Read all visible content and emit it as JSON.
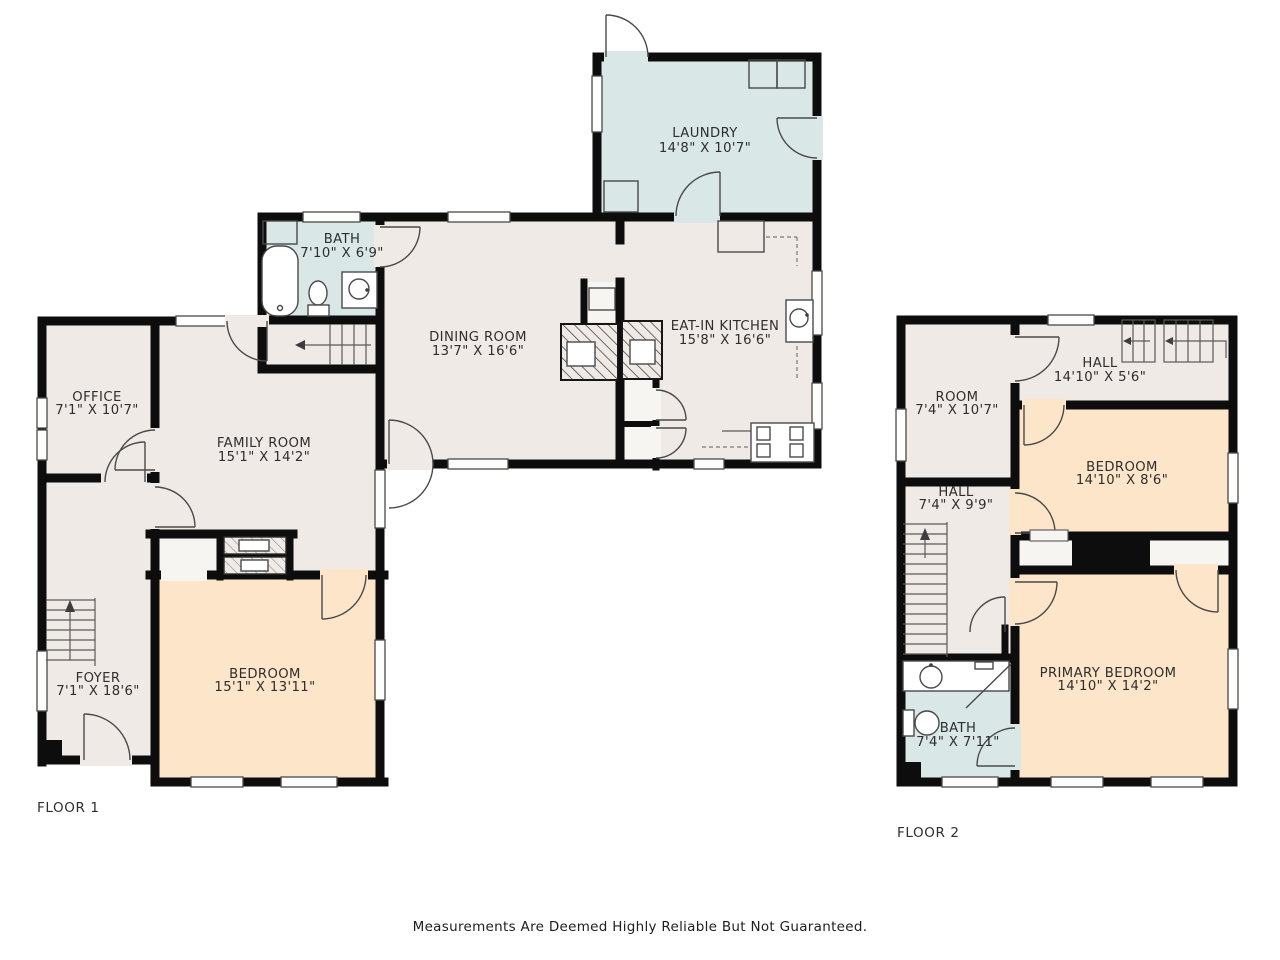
{
  "disclaimer": "Measurements Are Deemed Highly Reliable But Not Guaranteed.",
  "floors": [
    {
      "label": "FLOOR 1",
      "rooms": [
        {
          "name": "LAUNDRY",
          "dims": "14'8\" X 10'7\""
        },
        {
          "name": "BATH",
          "dims": "7'10\" X 6'9\""
        },
        {
          "name": "DINING ROOM",
          "dims": "13'7\" X 16'6\""
        },
        {
          "name": "EAT-IN KITCHEN",
          "dims": "15'8\" X 16'6\""
        },
        {
          "name": "OFFICE",
          "dims": "7'1\" X 10'7\""
        },
        {
          "name": "FAMILY ROOM",
          "dims": "15'1\" X 14'2\""
        },
        {
          "name": "FOYER",
          "dims": "7'1\" X 18'6\""
        },
        {
          "name": "BEDROOM",
          "dims": "15'1\" X 13'11\""
        }
      ]
    },
    {
      "label": "FLOOR 2",
      "rooms": [
        {
          "name": "ROOM",
          "dims": "7'4\" X 10'7\""
        },
        {
          "name": "HALL",
          "dims": "14'10\" X 5'6\""
        },
        {
          "name": "BEDROOM",
          "dims": "14'10\" X 8'6\""
        },
        {
          "name": "HALL",
          "dims": "7'4\" X 9'9\""
        },
        {
          "name": "PRIMARY BEDROOM",
          "dims": "14'10\" X 14'2\""
        },
        {
          "name": "BATH",
          "dims": "7'4\" X 7'11\""
        }
      ]
    }
  ],
  "colors": {
    "room_beige": "#efeae5",
    "room_blue": "#d9e7e6",
    "room_peach": "#fce5c9",
    "closet_fill": "#f7f5f2",
    "wall": "#0d0d0d",
    "text": "#2e2e2e"
  }
}
